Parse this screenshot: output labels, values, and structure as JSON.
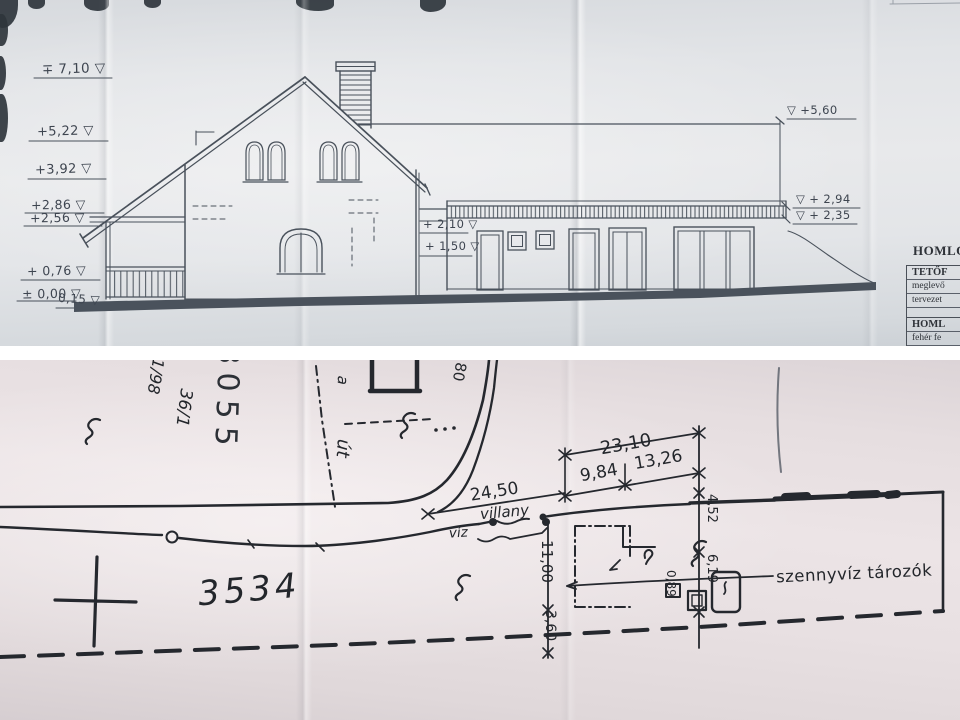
{
  "top_panel": {
    "description": "building elevation drawing",
    "levels": {
      "l710": "∓ 7,10 ▽",
      "l522": "+5,22 ▽",
      "l392": "+3,92 ▽",
      "l286": "+2,86 ▽",
      "l256": "+2,56 ▽",
      "l076": "+ 0,76 ▽",
      "l000": "± 0,00 ▽",
      "l015": "0,15 ▽",
      "l210": "+ 2,10 ▽",
      "l150": "+ 1,50 ▽",
      "l560": "▽ +5,60",
      "l294": "▽ + 2,94",
      "l235": "▽ + 2,35"
    },
    "table": {
      "title": "HOMLO",
      "h1": "TETŐF",
      "r1": "meglevő",
      "r2": "tervezet",
      "h2": "HOML",
      "r3": "fehér fe"
    }
  },
  "site_plan": {
    "description": "hand-drawn site plan",
    "parcels": {
      "main": "3534",
      "upper": "3055",
      "small_a": "1/98",
      "small_b": "36/1"
    },
    "road": {
      "a": "a",
      "ut": "út"
    },
    "dims": {
      "d2310": "23,10",
      "d984": "9,84",
      "d1326": "13,26",
      "d2450": "24,50",
      "d1100": "11,00",
      "d360": "3,60",
      "d452": "4,52",
      "d619": "6,19",
      "d089": "0,89",
      "d80": "80"
    },
    "utilities": {
      "villany": "villany",
      "viz": "víz",
      "szennyviz": "szennyvíz tározók"
    }
  }
}
